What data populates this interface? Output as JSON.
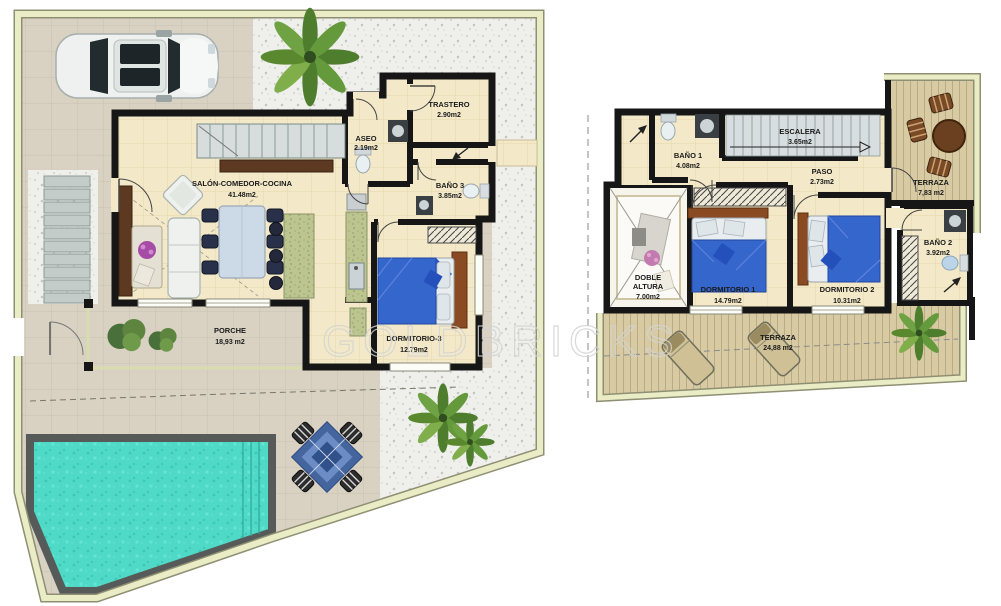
{
  "watermark": "GOLDBRICKS",
  "plans": {
    "ground": {
      "rooms": {
        "salon": {
          "name": "SALÓN-COMEDOR-COCINA",
          "area": "41.48m2"
        },
        "trastero": {
          "name": "TRASTERO",
          "area": "2.90m2"
        },
        "aseo": {
          "name": "ASEO",
          "area": "2.19m2"
        },
        "bano3": {
          "name": "BAÑO 3",
          "area": "3.85m2"
        },
        "dormitorio3": {
          "name": "DORMITORIO-3",
          "area": "12.79m2"
        },
        "porche": {
          "name": "PORCHE",
          "area": "18,93 m2"
        }
      }
    },
    "first": {
      "rooms": {
        "bano1": {
          "name": "BAÑO 1",
          "area": "4.08m2"
        },
        "escalera": {
          "name": "ESCALERA",
          "area": "3.65m2"
        },
        "paso": {
          "name": "PASO",
          "area": "2.73m2"
        },
        "terraza_superior": {
          "name": "TERRAZA",
          "area": "7,83 m2"
        },
        "doble_altura": {
          "line1": "DOBLE",
          "line2": "ALTURA",
          "area": "7.00m2"
        },
        "dormitorio1": {
          "name": "DORMITORIO 1",
          "area": "14.79m2"
        },
        "dormitorio2": {
          "name": "DORMITORIO 2",
          "area": "10.31m2"
        },
        "bano2": {
          "name": "BAÑO 2",
          "area": "3.92m2"
        },
        "terraza_inferior": {
          "name": "TERRAZA",
          "area": "24,88 m2"
        }
      }
    }
  },
  "colors": {
    "wall": "#161616",
    "floor_cream": "#f3e9c8",
    "patio": "#d9d2c3",
    "gravel": "#efefec",
    "wood_deck": "#d8cba4",
    "pool_water": "#4fdac7",
    "bed_blue": "#3566cc",
    "boundary_pale": "#e9ecc4"
  }
}
